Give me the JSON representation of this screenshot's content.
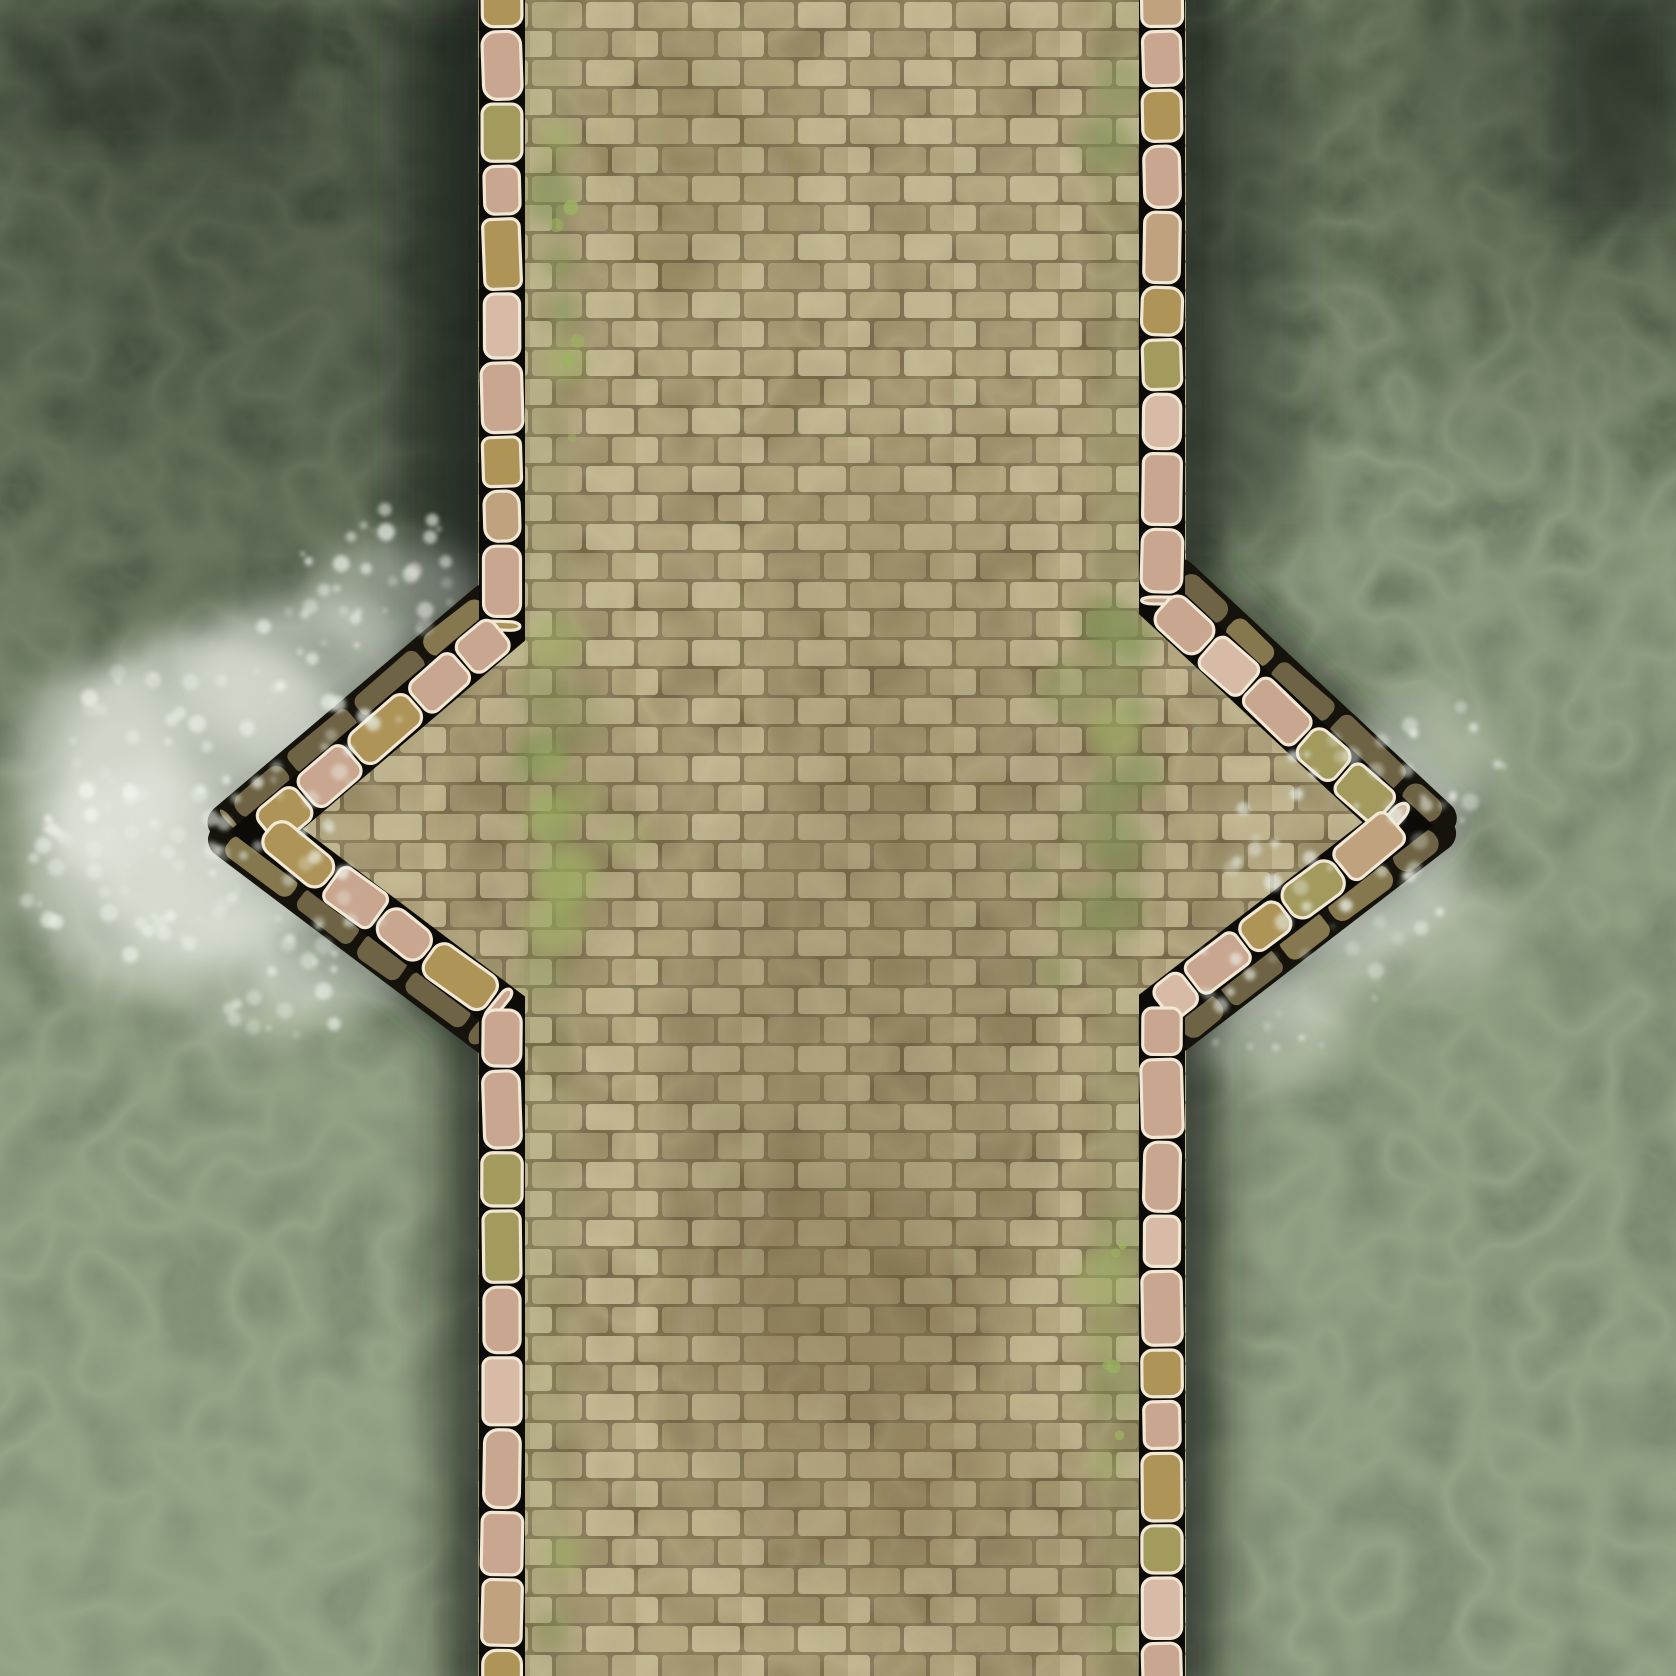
{
  "scene": {
    "type": "battle-map",
    "subject": "Top-down stone bridge crossing a green river",
    "features": [
      "river water with pale caustic ripple webbing",
      "weathered tan brick bridge deck running vertically",
      "parapet walls of rounded pink and olive stones with cream edges",
      "diamond bastion overlooks jutting out on both banks mid-span",
      "darker olive outer base-course stones along the bastion diagonals",
      "white churning foam at the cutwater points",
      "moss patches and brown grime staining the brickwork",
      "dark water shadow hugging the bridge footings"
    ]
  },
  "palette": {
    "water_top": "#5e6c54",
    "water_mid": "#6f7d66",
    "water_bottom": "#7f8d74",
    "water_caustic": "#a8b797",
    "water_caustic_fine": "#93a284",
    "water_mottle": "#39442f",
    "water_shadow": "#161c12",
    "foam": "#e9eee5",
    "foam_bright": "#f4f7f0",
    "deck_mortar": "#776a4b",
    "deck_brick": "#ac9f79",
    "deck_brick_light": "#bdb28d",
    "deck_brick_dark": "#9a8e69",
    "deck_grime": "#5d5134",
    "deck_wear": "#dcd3ab",
    "deck_dirt": "#6d5c3a",
    "moss": "#7f9454",
    "moss_bright": "#9db360",
    "stone_pink": "#c9a68f",
    "stone_pink_light": "#d8bba6",
    "stone_tan": "#c0a27e",
    "stone_olive": "#ae9457",
    "stone_moss": "#a39a5e",
    "stone_outline": "#f2e8d4",
    "stone_gap": "#0c0b08",
    "base_course": "#85784f",
    "base_course_dark": "#6e6344",
    "base_course_outline": "#15130c"
  }
}
